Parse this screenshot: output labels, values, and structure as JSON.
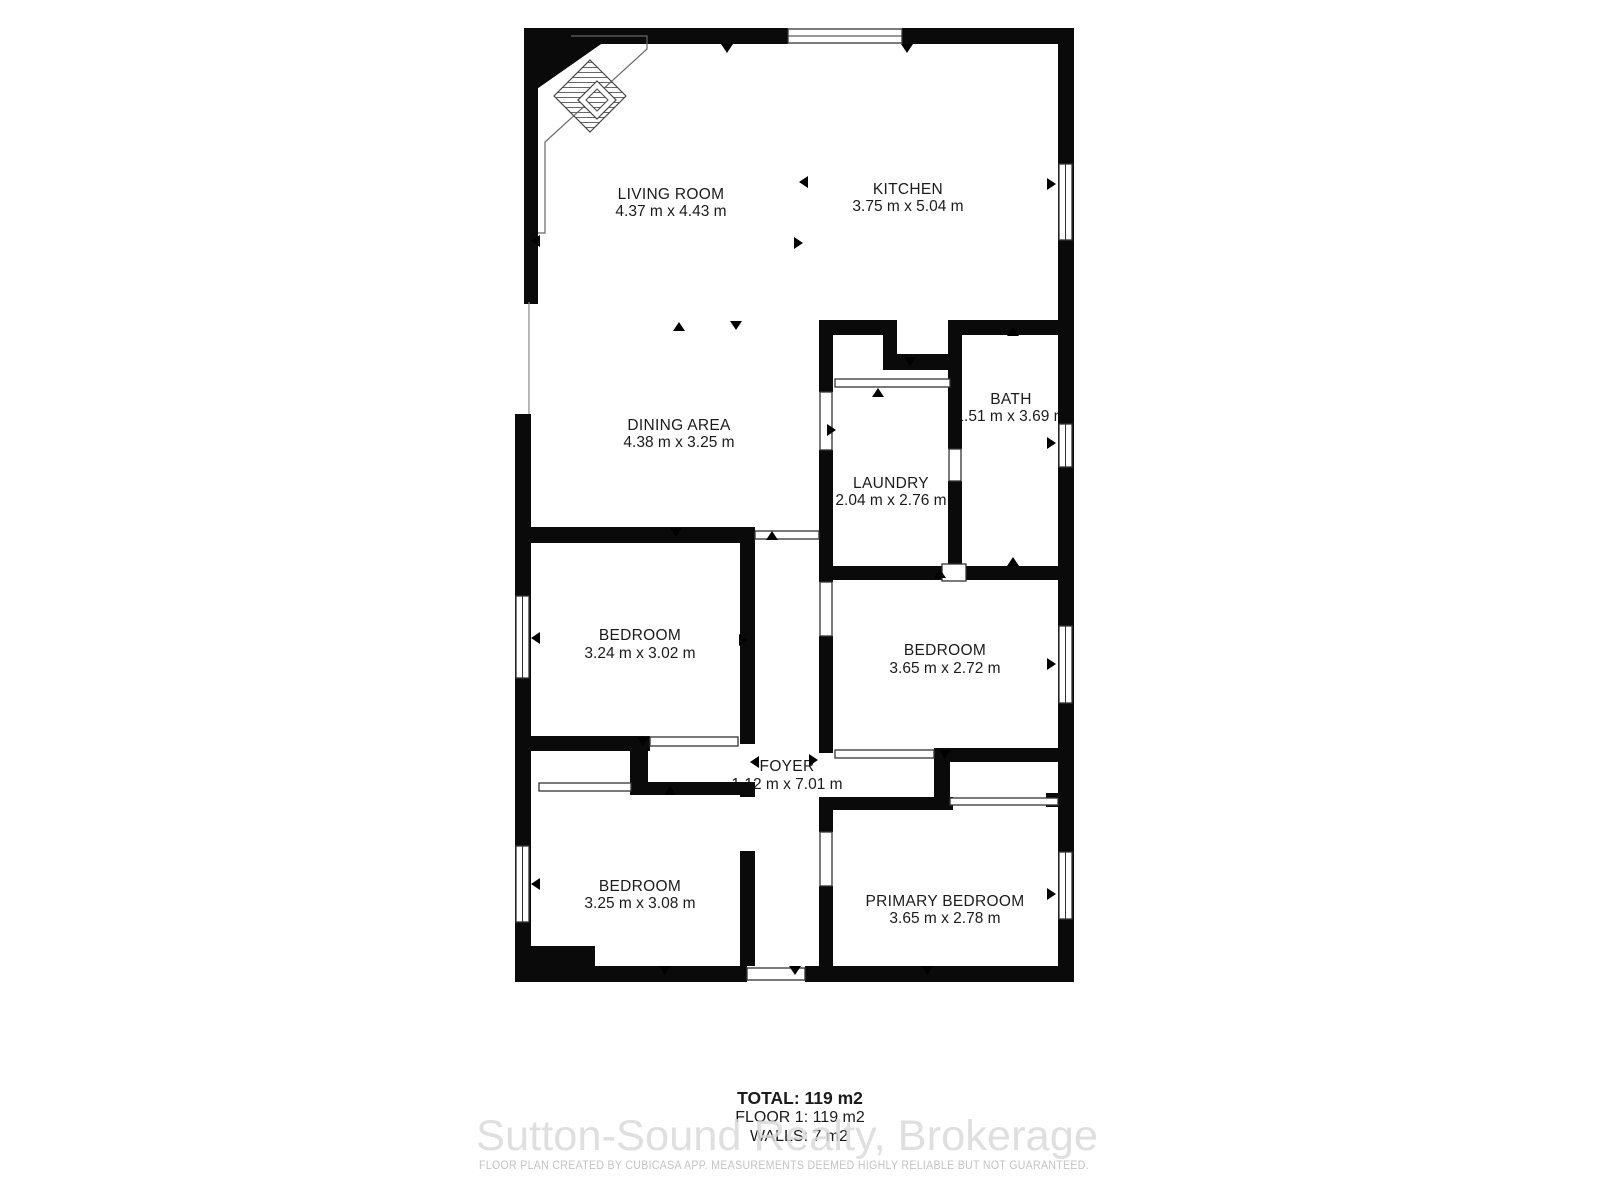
{
  "floor_plan": {
    "rooms": {
      "living": {
        "name": "LIVING ROOM",
        "dims": "4.37 m x 4.43 m"
      },
      "kitchen": {
        "name": "KITCHEN",
        "dims": "3.75 m x 5.04 m"
      },
      "dining": {
        "name": "DINING AREA",
        "dims": "4.38 m x 3.25 m"
      },
      "laundry": {
        "name": "LAUNDRY",
        "dims": "2.04 m x 2.76 m"
      },
      "bath": {
        "name": "BATH",
        "dims": "1.51 m x 3.69 m"
      },
      "bedroom_left": {
        "name": "BEDROOM",
        "dims": "3.24 m x 3.02 m"
      },
      "bedroom_right": {
        "name": "BEDROOM",
        "dims": "3.65 m x 2.72 m"
      },
      "foyer": {
        "name": "FOYER",
        "dims": "1.12 m x 7.01 m"
      },
      "bedroom_left2": {
        "name": "BEDROOM",
        "dims": "3.25 m x 3.08 m"
      },
      "primary": {
        "name": "PRIMARY BEDROOM",
        "dims": "3.65 m x 2.78 m"
      }
    },
    "summary": {
      "total": "TOTAL: 119 m2",
      "floor_1": "FLOOR 1: 119 m2",
      "walls": "WALLS: 7 m2"
    },
    "watermark": "Sutton-Sound Realty, Brokerage",
    "disclaimer": "FLOOR PLAN CREATED BY CUBICASA APP. MEASUREMENTS DEEMED HIGHLY RELIABLE BUT NOT GUARANTEED.",
    "colors": {
      "wall": "#0a0a0a",
      "label": "#1b1b1b",
      "watermark": "#d9d9d9",
      "disclaimer": "#c3c3c3"
    }
  }
}
